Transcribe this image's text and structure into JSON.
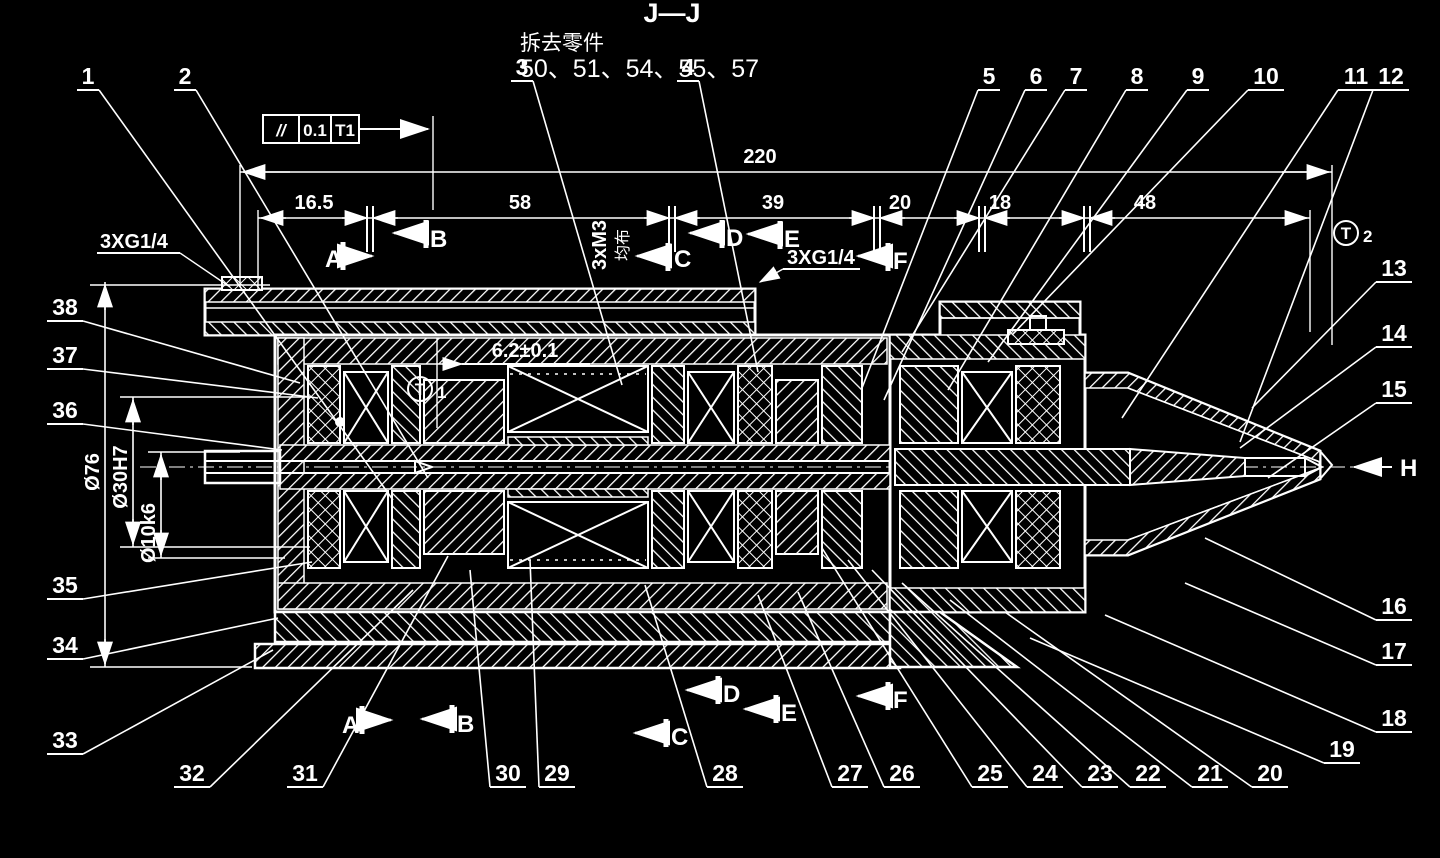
{
  "page": {
    "background": "#000000",
    "line_color": "#ffffff"
  },
  "title": {
    "section_label": "J—J",
    "removal_note": "拆去零件",
    "removed_parts": "50、51、54、55、57"
  },
  "feature_control_frame": {
    "symbol": "//",
    "tolerance": "0.1",
    "datum": "T1"
  },
  "datum_targets": [
    {
      "letter": "T",
      "digit": "1",
      "x": 420,
      "y": 389
    },
    {
      "letter": "T",
      "digit": "2",
      "x": 1346,
      "y": 233
    }
  ],
  "annotations": {
    "port_left": "3XG1/4",
    "port_right": "3XG1/4",
    "bolt_pattern": "3xM3",
    "bolt_pattern_note": "均布",
    "width_dim": "6.2±0.1",
    "view_arrow": "H"
  },
  "dimensions": {
    "overall": {
      "text": "220",
      "x1": 240,
      "x2": 1332,
      "y": 172,
      "label_x": 760,
      "label_y": 163
    },
    "row_y": 218,
    "segments": [
      {
        "text": "16.5",
        "x1": 258,
        "x2": 370,
        "label_x": 314
      },
      {
        "text": "58",
        "x1": 370,
        "x2": 672,
        "label_x": 520
      },
      {
        "text": "39",
        "x1": 672,
        "x2": 877,
        "label_x": 773
      },
      {
        "text": "20",
        "x1": 877,
        "x2": 982,
        "label_x": 900
      },
      {
        "text": "18",
        "x1": 982,
        "x2": 1087,
        "label_x": 1000
      },
      {
        "text": "48",
        "x1": 1087,
        "x2": 1310,
        "label_x": 1145
      }
    ],
    "diameters": [
      {
        "text": "Ø76",
        "x": 105,
        "y1": 282,
        "y2": 667,
        "label_y": 472
      },
      {
        "text": "Ø30H7",
        "x": 133,
        "y1": 397,
        "y2": 547,
        "label_y": 477
      },
      {
        "text": "Ø10k6",
        "x": 161,
        "y1": 452,
        "y2": 558,
        "label_y": 533
      }
    ]
  },
  "section_markers": {
    "top": [
      {
        "letter": "A",
        "lx": 325,
        "ly": 267,
        "bar_x": 343,
        "bar_y1": 242,
        "bar_y2": 270,
        "ax1": 343,
        "ax2": 372,
        "ay": 256,
        "dir": "right"
      },
      {
        "letter": "B",
        "lx": 430,
        "ly": 247,
        "bar_x": 426,
        "bar_y1": 220,
        "bar_y2": 248,
        "ax1": 424,
        "ax2": 394,
        "ay": 233,
        "dir": "left"
      },
      {
        "letter": "C",
        "lx": 674,
        "ly": 267,
        "bar_x": 668,
        "bar_y1": 243,
        "bar_y2": 271,
        "ax1": 666,
        "ax2": 637,
        "ay": 256,
        "dir": "left"
      },
      {
        "letter": "D",
        "lx": 726,
        "ly": 246,
        "bar_x": 722,
        "bar_y1": 220,
        "bar_y2": 248,
        "ax1": 720,
        "ax2": 690,
        "ay": 233,
        "dir": "left"
      },
      {
        "letter": "E",
        "lx": 784,
        "ly": 247,
        "bar_x": 780,
        "bar_y1": 221,
        "bar_y2": 249,
        "ax1": 778,
        "ax2": 748,
        "ay": 234,
        "dir": "left"
      },
      {
        "letter": "F",
        "lx": 893,
        "ly": 269,
        "bar_x": 888,
        "bar_y1": 243,
        "bar_y2": 271,
        "ax1": 886,
        "ax2": 858,
        "ay": 256,
        "dir": "left"
      }
    ],
    "bottom": [
      {
        "letter": "A",
        "lx": 342,
        "ly": 733,
        "bar_x": 362,
        "bar_y1": 706,
        "bar_y2": 734,
        "ax1": 362,
        "ax2": 391,
        "ay": 720,
        "dir": "right"
      },
      {
        "letter": "B",
        "lx": 457,
        "ly": 732,
        "bar_x": 452,
        "bar_y1": 705,
        "bar_y2": 733,
        "ax1": 450,
        "ax2": 422,
        "ay": 719,
        "dir": "left"
      },
      {
        "letter": "C",
        "lx": 671,
        "ly": 745,
        "bar_x": 666,
        "bar_y1": 719,
        "bar_y2": 747,
        "ax1": 664,
        "ax2": 635,
        "ay": 733,
        "dir": "left"
      },
      {
        "letter": "D",
        "lx": 723,
        "ly": 702,
        "bar_x": 718,
        "bar_y1": 676,
        "bar_y2": 704,
        "ax1": 716,
        "ax2": 687,
        "ay": 690,
        "dir": "left"
      },
      {
        "letter": "E",
        "lx": 781,
        "ly": 721,
        "bar_x": 776,
        "bar_y1": 695,
        "bar_y2": 723,
        "ax1": 774,
        "ax2": 745,
        "ay": 709,
        "dir": "left"
      },
      {
        "letter": "F",
        "lx": 893,
        "ly": 708,
        "bar_x": 888,
        "bar_y1": 682,
        "bar_y2": 710,
        "ax1": 886,
        "ax2": 858,
        "ay": 696,
        "dir": "left"
      }
    ]
  },
  "view_arrow_marker": {
    "letter": "H",
    "tip_x": 1350,
    "tail_x": 1392,
    "y": 467,
    "label_x": 1400,
    "label_y": 476
  },
  "callouts": [
    {
      "n": "1",
      "x": 88,
      "y": 84,
      "side": 1,
      "tx": 393,
      "ty": 500
    },
    {
      "n": "2",
      "x": 185,
      "y": 84,
      "side": 1,
      "tx": 428,
      "ty": 478
    },
    {
      "n": "3",
      "x": 522,
      "y": 75,
      "side": 1,
      "tx": 622,
      "ty": 385
    },
    {
      "n": "4",
      "x": 688,
      "y": 75,
      "side": 1,
      "tx": 758,
      "ty": 372
    },
    {
      "n": "5",
      "x": 989,
      "y": 84,
      "side": -1,
      "tx": 862,
      "ty": 388
    },
    {
      "n": "6",
      "x": 1036,
      "y": 84,
      "side": -1,
      "tx": 884,
      "ty": 400
    },
    {
      "n": "7",
      "x": 1076,
      "y": 84,
      "side": -1,
      "tx": 902,
      "ty": 352
    },
    {
      "n": "8",
      "x": 1137,
      "y": 84,
      "side": -1,
      "tx": 948,
      "ty": 390
    },
    {
      "n": "9",
      "x": 1198,
      "y": 84,
      "side": -1,
      "tx": 988,
      "ty": 362
    },
    {
      "n": "10",
      "x": 1266,
      "y": 84,
      "side": -1,
      "tx": 1012,
      "ty": 335
    },
    {
      "n": "11",
      "x": 1356,
      "y": 84,
      "side": -1,
      "tx": 1122,
      "ty": 418
    },
    {
      "n": "12",
      "x": 1391,
      "y": 84,
      "side": -1,
      "tx": 1240,
      "ty": 442
    },
    {
      "n": "13",
      "x": 1394,
      "y": 276,
      "side": -1,
      "tx": 1252,
      "ty": 408
    },
    {
      "n": "14",
      "x": 1394,
      "y": 341,
      "side": -1,
      "tx": 1240,
      "ty": 448
    },
    {
      "n": "15",
      "x": 1394,
      "y": 397,
      "side": -1,
      "tx": 1268,
      "ty": 478
    },
    {
      "n": "16",
      "x": 1394,
      "y": 614,
      "side": -1,
      "tx": 1205,
      "ty": 538
    },
    {
      "n": "17",
      "x": 1394,
      "y": 659,
      "side": -1,
      "tx": 1185,
      "ty": 583
    },
    {
      "n": "18",
      "x": 1394,
      "y": 726,
      "side": -1,
      "tx": 1105,
      "ty": 615
    },
    {
      "n": "19",
      "x": 1342,
      "y": 757,
      "side": -1,
      "tx": 1030,
      "ty": 638
    },
    {
      "n": "20",
      "x": 1270,
      "y": 781,
      "side": -1,
      "tx": 1005,
      "ty": 612
    },
    {
      "n": "21",
      "x": 1210,
      "y": 781,
      "side": -1,
      "tx": 950,
      "ty": 600
    },
    {
      "n": "22",
      "x": 1148,
      "y": 781,
      "side": -1,
      "tx": 902,
      "ty": 583
    },
    {
      "n": "23",
      "x": 1100,
      "y": 781,
      "side": -1,
      "tx": 872,
      "ty": 570
    },
    {
      "n": "24",
      "x": 1045,
      "y": 781,
      "side": -1,
      "tx": 848,
      "ty": 560
    },
    {
      "n": "25",
      "x": 990,
      "y": 781,
      "side": -1,
      "tx": 822,
      "ty": 548
    },
    {
      "n": "26",
      "x": 902,
      "y": 781,
      "side": -1,
      "tx": 798,
      "ty": 592
    },
    {
      "n": "27",
      "x": 850,
      "y": 781,
      "side": -1,
      "tx": 758,
      "ty": 595
    },
    {
      "n": "28",
      "x": 725,
      "y": 781,
      "side": -1,
      "tx": 645,
      "ty": 585
    },
    {
      "n": "29",
      "x": 557,
      "y": 781,
      "side": -1,
      "tx": 530,
      "ty": 560
    },
    {
      "n": "30",
      "x": 508,
      "y": 781,
      "side": -1,
      "tx": 470,
      "ty": 570
    },
    {
      "n": "31",
      "x": 305,
      "y": 781,
      "side": 1,
      "tx": 448,
      "ty": 556
    },
    {
      "n": "32",
      "x": 192,
      "y": 781,
      "side": 1,
      "tx": 413,
      "ty": 590
    },
    {
      "n": "33",
      "x": 65,
      "y": 748,
      "side": 1,
      "tx": 273,
      "ty": 650
    },
    {
      "n": "34",
      "x": 65,
      "y": 653,
      "side": 1,
      "tx": 278,
      "ty": 618
    },
    {
      "n": "35",
      "x": 65,
      "y": 593,
      "side": 1,
      "tx": 312,
      "ty": 562
    },
    {
      "n": "36",
      "x": 65,
      "y": 418,
      "side": 1,
      "tx": 282,
      "ty": 450
    },
    {
      "n": "37",
      "x": 65,
      "y": 363,
      "side": 1,
      "tx": 318,
      "ty": 398
    },
    {
      "n": "38",
      "x": 65,
      "y": 315,
      "side": 1,
      "tx": 300,
      "ty": 383
    }
  ]
}
